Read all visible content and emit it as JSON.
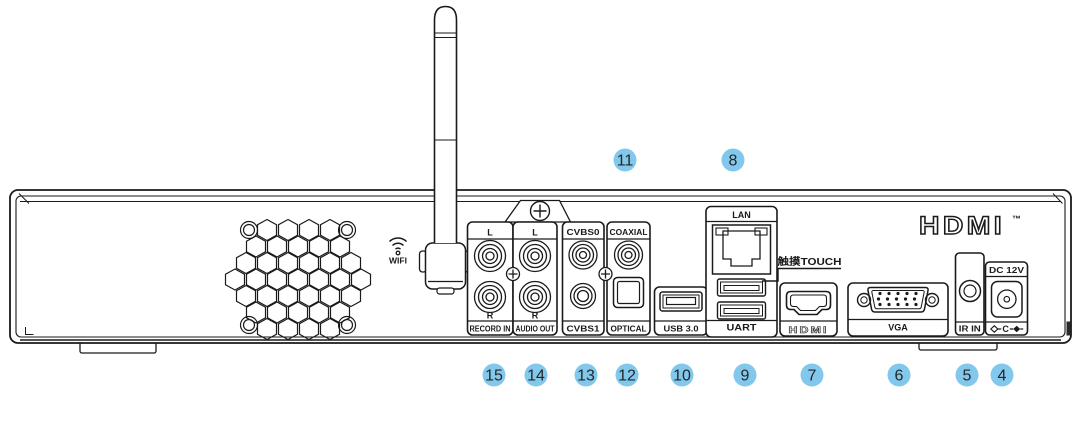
{
  "branding": {
    "hdmi_logo": "HDMI",
    "hdmi_trademark": "™"
  },
  "wifi": {
    "label": "WIFI"
  },
  "ports": {
    "record_in": {
      "top": "L",
      "bottom": "R",
      "label": "RECORD IN"
    },
    "audio_out": {
      "top": "L",
      "bottom": "R",
      "label": "AUDIO OUT"
    },
    "cvbs": {
      "top": "CVBS0",
      "bottom": "CVBS1"
    },
    "digital_audio": {
      "top": "COAXIAL",
      "bottom": "OPTICAL"
    },
    "usb": {
      "label": "USB 3.0"
    },
    "lan": {
      "top": "LAN",
      "bottom": "UART"
    },
    "touch": {
      "label": "触摸TOUCH"
    },
    "hdmi": {
      "label": "HDMI"
    },
    "vga": {
      "label": "VGA"
    },
    "ir": {
      "label": "IR IN"
    },
    "dc": {
      "label": "DC 12V",
      "polarity_center": "C"
    }
  },
  "callouts": {
    "top": [
      "11",
      "8"
    ],
    "bottom": [
      "15",
      "14",
      "13",
      "12",
      "10",
      "9",
      "7",
      "6",
      "5",
      "4"
    ]
  },
  "colors": {
    "callout_bg": "#82C8EC",
    "callout_text": "#262626",
    "line_art": "#1A1A1A",
    "background": "#FFFFFF"
  }
}
